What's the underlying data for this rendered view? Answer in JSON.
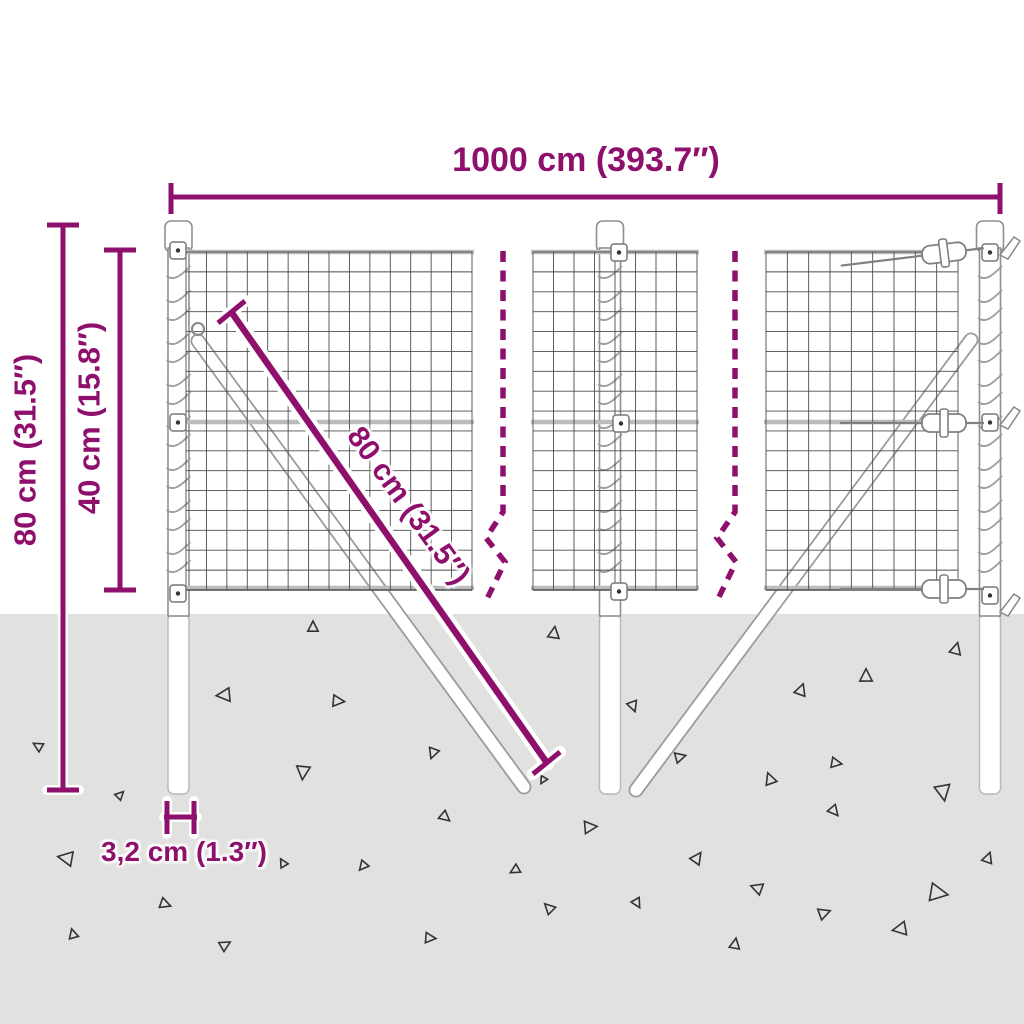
{
  "title": "Wire mesh fence dimension diagram",
  "colors": {
    "accent": "#8e106c",
    "ground": "#e1e1e0",
    "wire": "#4c4c4c",
    "rail": "#bcbcbc",
    "steel": "#8f8f8f",
    "triangle": "#333333"
  },
  "labels": {
    "total_width": "1000 cm (393.7″)",
    "total_height": "80 cm (31.5″)",
    "panel_height": "40 cm (15.8″)",
    "brace_length": "80 cm (31.5″)",
    "post_diameter": "3,2 cm (1.3″)"
  },
  "ground": {
    "triangles_xysr": [
      [
        313,
        627,
        10,
        0
      ],
      [
        554,
        633,
        11,
        8
      ],
      [
        866,
        676,
        12,
        0
      ],
      [
        956,
        649,
        11,
        15
      ],
      [
        224,
        695,
        13,
        265
      ],
      [
        338,
        701,
        11,
        95
      ],
      [
        433,
        753,
        10,
        200
      ],
      [
        801,
        690,
        11,
        20
      ],
      [
        633,
        706,
        10,
        160
      ],
      [
        38,
        746,
        9,
        300
      ],
      [
        303,
        772,
        13,
        185
      ],
      [
        445,
        817,
        10,
        130
      ],
      [
        680,
        757,
        10,
        75
      ],
      [
        770,
        779,
        11,
        340
      ],
      [
        836,
        763,
        10,
        100
      ],
      [
        943,
        792,
        15,
        170
      ],
      [
        66,
        858,
        14,
        280
      ],
      [
        165,
        904,
        10,
        110
      ],
      [
        73,
        934,
        9,
        345
      ],
      [
        225,
        945,
        10,
        60
      ],
      [
        515,
        870,
        9,
        240
      ],
      [
        590,
        827,
        12,
        85
      ],
      [
        697,
        858,
        11,
        35
      ],
      [
        757,
        888,
        11,
        290
      ],
      [
        834,
        811,
        10,
        140
      ],
      [
        938,
        893,
        17,
        100
      ],
      [
        988,
        858,
        10,
        20
      ],
      [
        549,
        908,
        10,
        315
      ],
      [
        637,
        903,
        9,
        150
      ],
      [
        824,
        913,
        11,
        70
      ],
      [
        900,
        929,
        13,
        260
      ],
      [
        735,
        944,
        10,
        10
      ],
      [
        363,
        866,
        9,
        220
      ],
      [
        430,
        938,
        10,
        95
      ],
      [
        283,
        863,
        8,
        330
      ],
      [
        543,
        780,
        7,
        210
      ],
      [
        120,
        795,
        8,
        45
      ]
    ]
  }
}
